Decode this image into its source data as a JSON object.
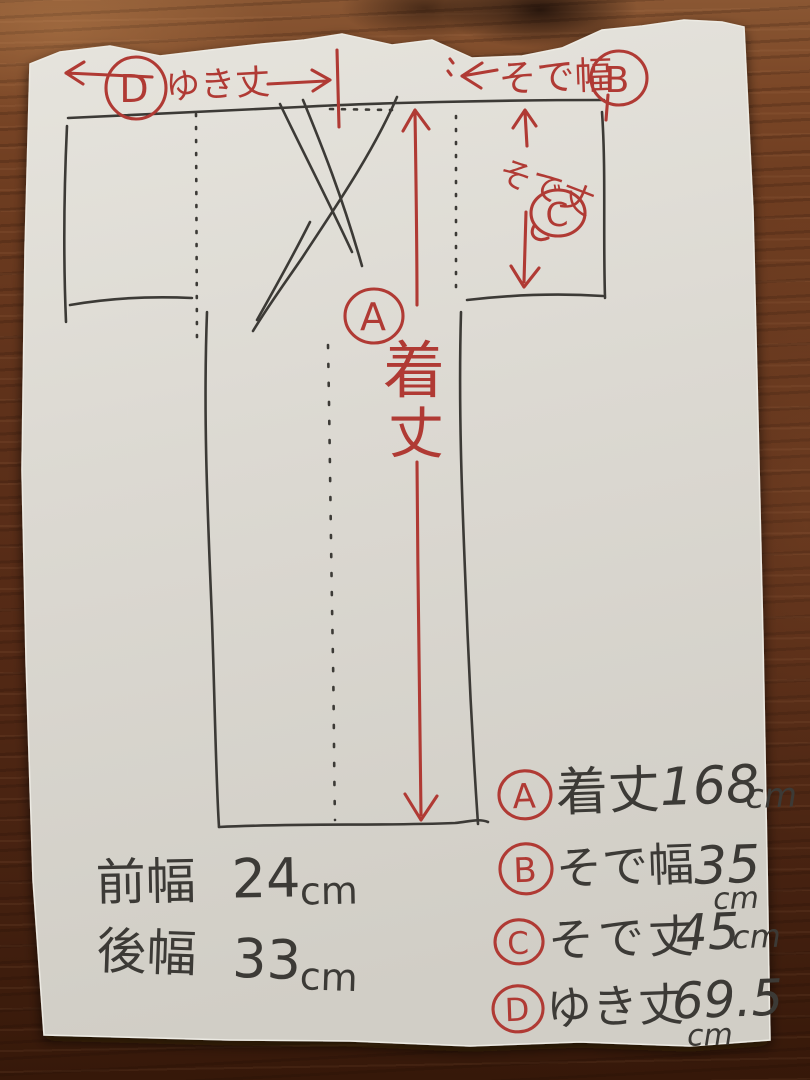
{
  "colors": {
    "paper": "#dcd9d2",
    "wood_light": "#8a5733",
    "wood_dark": "#361809",
    "red_ink": "#b03a34",
    "black_ink": "#3c3a36"
  },
  "annotations": {
    "length": {
      "letter": "A",
      "char1": "着",
      "char2": "丈"
    },
    "sleeve_width": {
      "letter": "B",
      "label": "そで幅"
    },
    "sleeve_length": {
      "letter": "C",
      "label": "そで丈"
    },
    "yuki": {
      "letter": "D",
      "label": "ゆき丈"
    }
  },
  "notes": {
    "front_width": {
      "label": "前幅",
      "value": "24",
      "unit": "cm"
    },
    "back_width": {
      "label": "後幅",
      "value": "33",
      "unit": "cm"
    }
  },
  "legend": {
    "rows": [
      {
        "letter": "A",
        "label": "着丈",
        "value": "168",
        "unit": "cm"
      },
      {
        "letter": "B",
        "label": "そで幅",
        "value": "35",
        "unit": "cm"
      },
      {
        "letter": "C",
        "label": "そで丈",
        "value": "45",
        "unit": "cm"
      },
      {
        "letter": "D",
        "label": "ゆき丈",
        "value": "69.5",
        "unit": "cm"
      }
    ]
  }
}
